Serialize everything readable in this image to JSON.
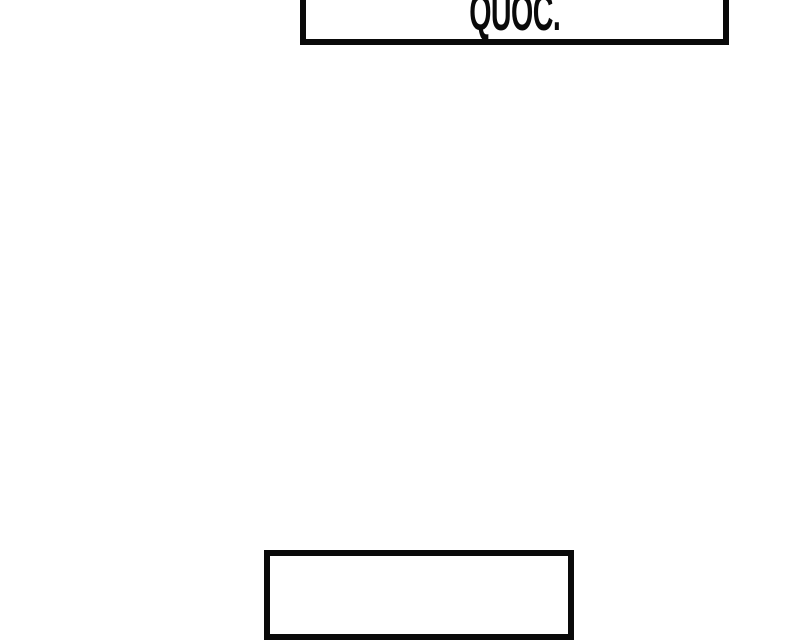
{
  "page": {
    "background_color": "#ffffff",
    "description": "comic strip segment with two caption boxes, both cropped by the frame edges"
  },
  "panels": {
    "top_caption": {
      "text": "QUOC.",
      "text_color": "#0a0a0a",
      "border_color": "#0a0a0a",
      "fill_color": "#ffffff"
    },
    "bottom_caption": {
      "text": "",
      "border_color": "#0a0a0a",
      "fill_color": "#ffffff"
    }
  }
}
